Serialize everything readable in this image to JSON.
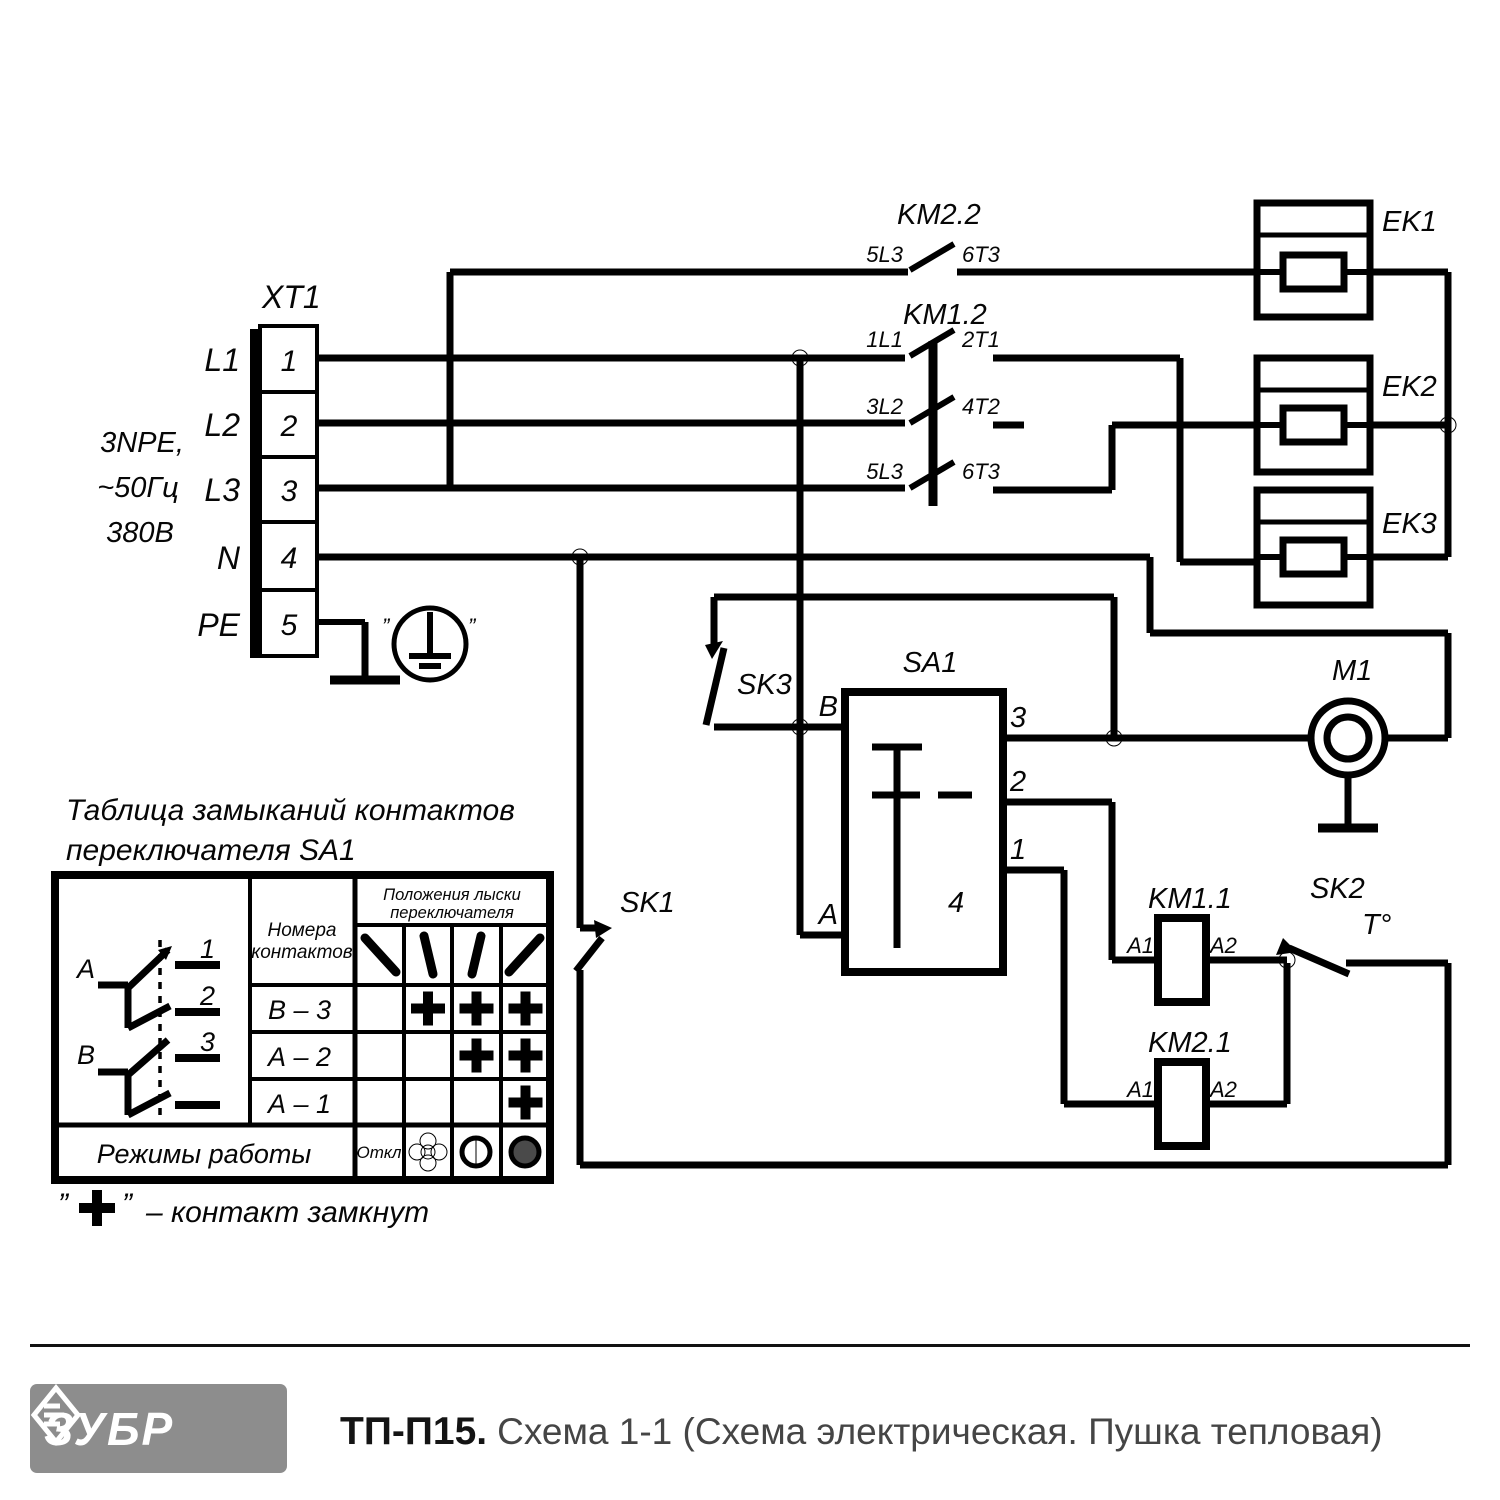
{
  "schematic": {
    "supply": {
      "l1": "3NPE,",
      "l2": "~50Гц",
      "l3": "380В"
    },
    "xt1": {
      "label": "XT1",
      "terminals": [
        {
          "line": "L1",
          "num": "1"
        },
        {
          "line": "L2",
          "num": "2"
        },
        {
          "line": "L3",
          "num": "3"
        },
        {
          "line": "N",
          "num": "4"
        },
        {
          "line": "PE",
          "num": "5"
        }
      ]
    },
    "pe_quote_open": "”",
    "pe_quote_close": "”",
    "km22": {
      "label": "KM2.2",
      "t_in": "5L3",
      "t_out": "6T3"
    },
    "km12": {
      "label": "KM1.2",
      "poles": [
        {
          "tin": "1L1",
          "tout": "2T1"
        },
        {
          "tin": "3L2",
          "tout": "4T2"
        },
        {
          "tin": "5L3",
          "tout": "6T3"
        }
      ]
    },
    "heaters": [
      {
        "label": "EK1"
      },
      {
        "label": "EK2"
      },
      {
        "label": "EK3"
      }
    ],
    "sa1": {
      "label": "SA1",
      "term_b": "B",
      "term_a": "A",
      "t3": "3",
      "t2": "2",
      "t1": "1",
      "t4": "4"
    },
    "sk1": {
      "label": "SK1"
    },
    "sk2": {
      "label": "SK2",
      "temp": "T°"
    },
    "sk3": {
      "label": "SK3"
    },
    "m1": {
      "label": "M1"
    },
    "km11": {
      "label": "KM1.1",
      "a1": "A1",
      "a2": "A2"
    },
    "km21": {
      "label": "KM2.1",
      "a1": "A1",
      "a2": "A2"
    }
  },
  "table": {
    "title_l1": "Таблица замыканий контактов",
    "title_l2": "переключателя SA1",
    "contacts_l1": "Номера",
    "contacts_l2": "контактов",
    "positions_l1": "Положения лыски",
    "positions_l2": "переключателя",
    "rows": [
      "В – 3",
      "А – 2",
      "А – 1"
    ],
    "marks": [
      [
        0,
        1,
        1,
        1
      ],
      [
        0,
        0,
        1,
        1
      ],
      [
        0,
        0,
        0,
        1
      ]
    ],
    "modes_label": "Режимы работы",
    "off_label": "Откл",
    "diagram": {
      "a": "A",
      "b": "B",
      "n1": "1",
      "n2": "2",
      "n3": "3"
    },
    "legend_open": "”",
    "legend_close": "”",
    "legend_text": "– контакт замкнут"
  },
  "footer": {
    "brand": "ЗУБР",
    "model": "ТП-П15.",
    "caption": "Схема 1-1 (Схема электрическая. Пушка тепловая)"
  },
  "colors": {
    "line": "#000000",
    "logo_gray": "#8d8d8d",
    "caption_gray": "#454545"
  }
}
